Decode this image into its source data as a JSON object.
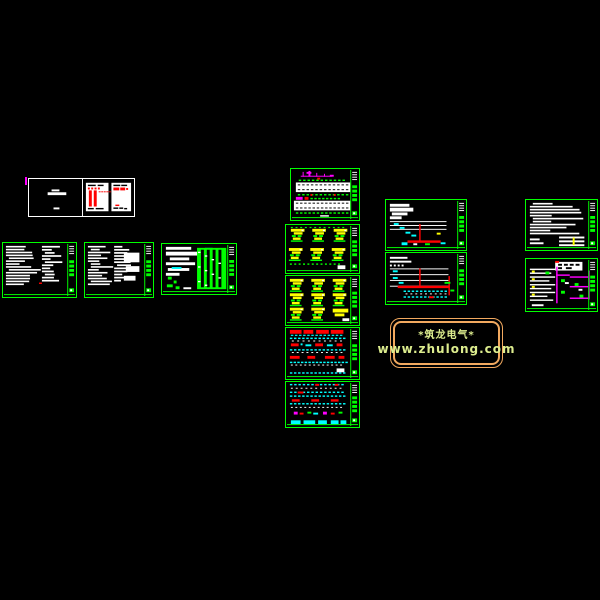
{
  "canvas": {
    "width": 600,
    "height": 600,
    "background": "#000000"
  },
  "watermark": {
    "line1": "*筑龙电气*",
    "line2": "www.zhulong.com",
    "border_color": "#f2a95f",
    "text_color": "#dded8e"
  },
  "palette": {
    "frame_green": "#00ff00",
    "white": "#ffffff",
    "red": "#ff0000",
    "magenta": "#ff00ff",
    "cyan": "#00ffff",
    "yellow": "#ffff00",
    "background": "#000000"
  },
  "sheet_count": 14
}
